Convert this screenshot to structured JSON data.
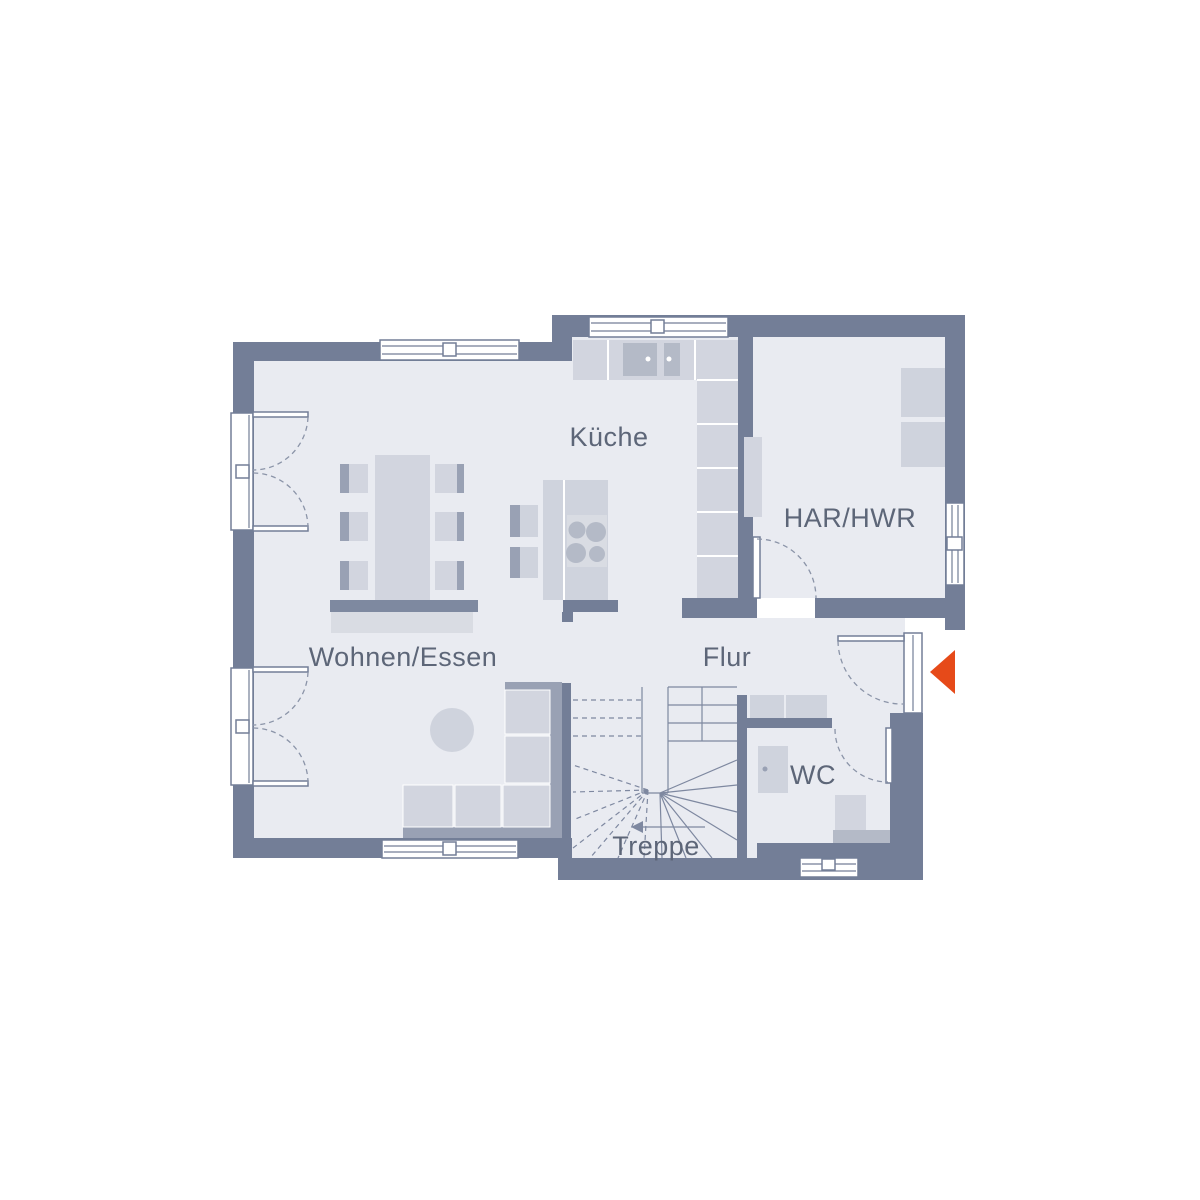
{
  "rooms": {
    "kueche": "Küche",
    "har": "HAR/HWR",
    "wohnen": "Wohnen/Essen",
    "flur": "Flur",
    "wc": "WC",
    "treppe": "Treppe"
  },
  "colors": {
    "background": "#ffffff",
    "wall": "#737e97",
    "floor": "#e9ebf1",
    "furniture_light": "#d2d5df",
    "furniture_medium": "#b4bac7",
    "furniture_back": "#99a1b4",
    "label_text": "#5d6678",
    "accent_arrow": "#e64a19"
  },
  "icons": {
    "entrance_arrow": "left-pointing-entrance-triangle",
    "stair_direction_arrow": "left-pointing-stair-arrow"
  }
}
